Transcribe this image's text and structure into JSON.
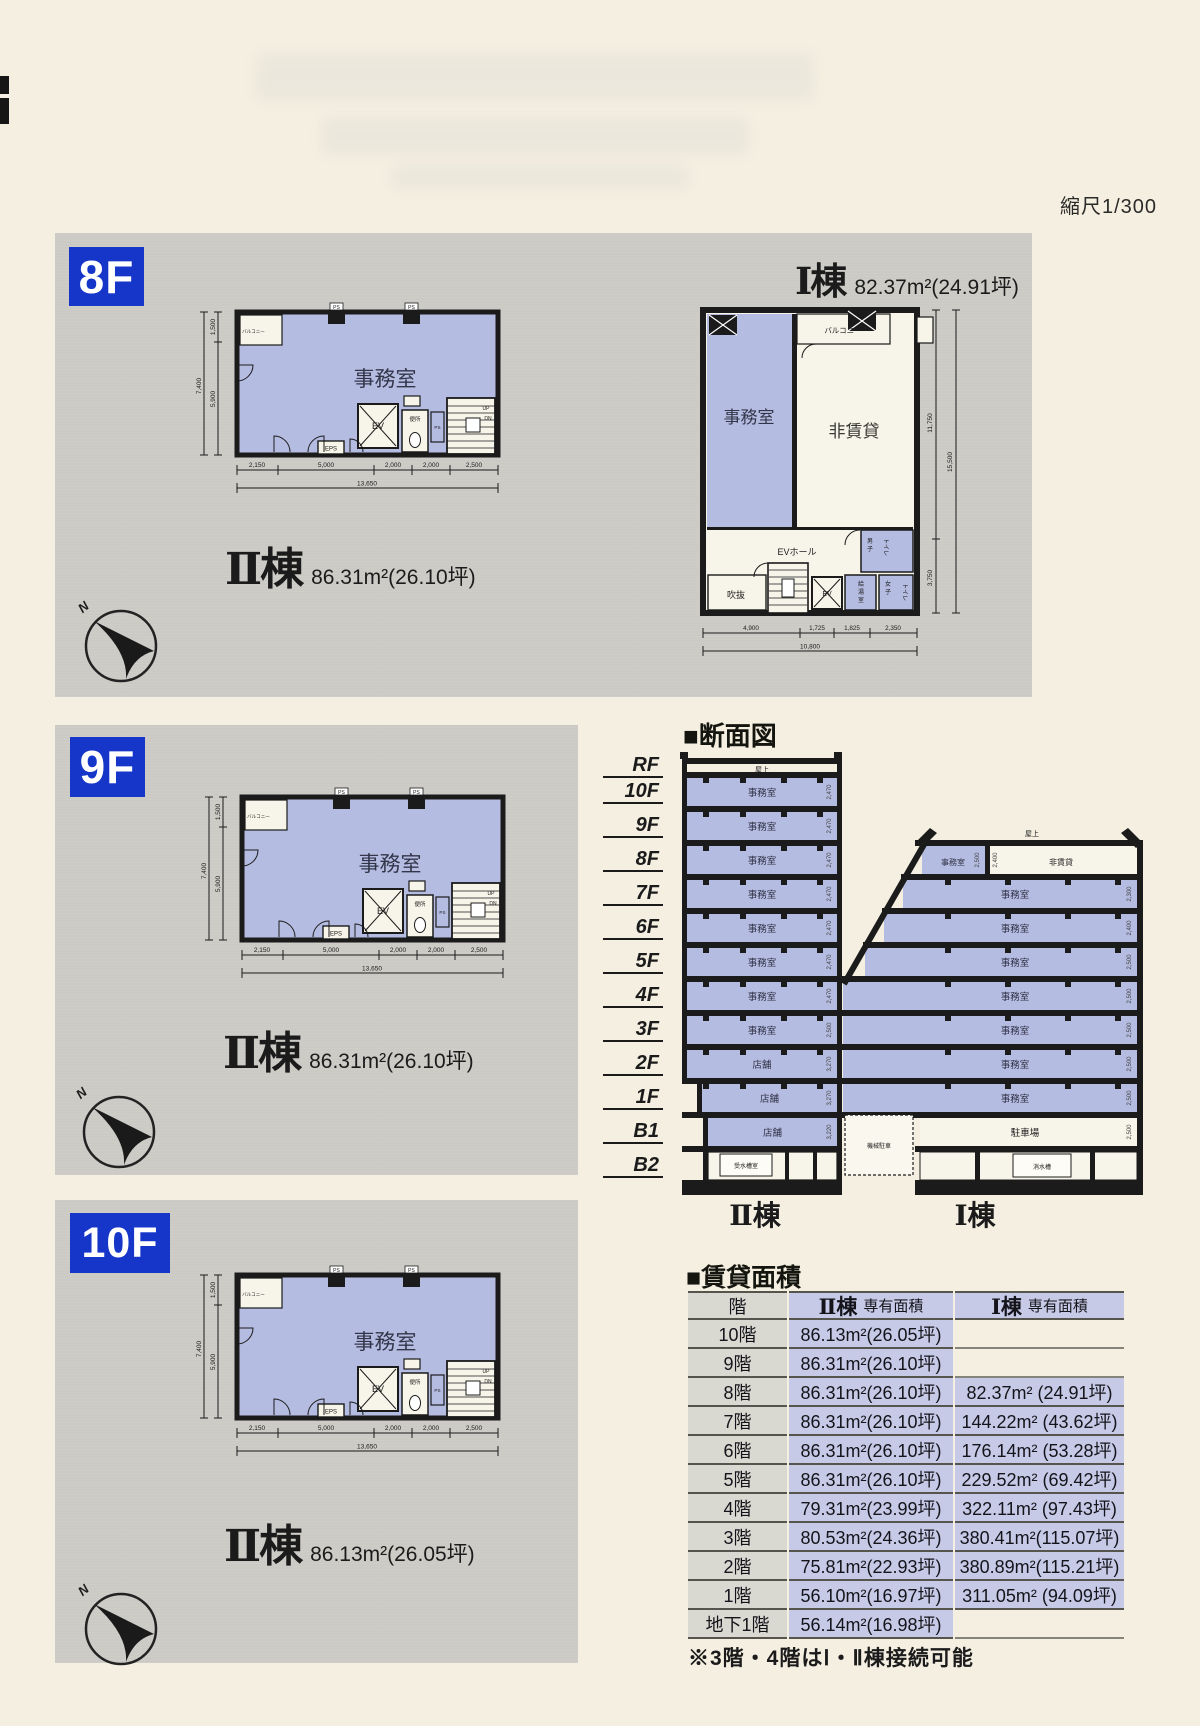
{
  "page": {
    "scale_note": "縮尺1/300"
  },
  "labels": {
    "office": "事務室",
    "store": "店舗",
    "balcony": "バルコニー",
    "non_rental": "非賃貸",
    "ev": "EV",
    "ev_hall": "EVホール",
    "eps": "EPS",
    "ps": "PS",
    "toilet": "便所",
    "up": "UP",
    "dn": "DN",
    "north": "N",
    "rooftop": "屋上",
    "mens": "男子",
    "womens": "女子",
    "toilet_kana": "トイレ",
    "void_space": "吹抜",
    "kitchenette": "給湯室",
    "water_tank_room": "受水槽室",
    "parking": "駐車場",
    "machine_parking": "機械駐車",
    "drainage_tank": "消水槽"
  },
  "floors": {
    "f8": {
      "tag": "8F",
      "b2_name": "Ⅱ棟",
      "b2_area": "86.31m²(26.10坪)",
      "b1_name": "Ⅰ棟",
      "b1_area": "82.37m²(24.91坪)"
    },
    "f9": {
      "tag": "9F",
      "b2_name": "Ⅱ棟",
      "b2_area": "86.31m²(26.10坪)"
    },
    "f10": {
      "tag": "10F",
      "b2_name": "Ⅱ棟",
      "b2_area": "86.13m²(26.05坪)"
    }
  },
  "plan2_dims": {
    "v_total": "7,400",
    "v_upper": "1,500",
    "v_lower": "5,900",
    "h": [
      "2,150",
      "5,000",
      "2,000",
      "2,000",
      "2,500"
    ],
    "h_total": "13,650"
  },
  "plan1_dims": {
    "v_upper": "11,750",
    "v_total": "15,500",
    "v_lower": "3,750",
    "h": [
      "4,900",
      "1,725",
      "1,825",
      "2,350"
    ],
    "h_total": "10,800"
  },
  "section": {
    "title": "■断面図",
    "floor_labels": [
      "RF",
      "10F",
      "9F",
      "8F",
      "7F",
      "6F",
      "5F",
      "4F",
      "3F",
      "2F",
      "1F",
      "B1",
      "B2"
    ],
    "b2_label": "Ⅱ棟",
    "b1_label": "Ⅰ棟",
    "b2_rows": [
      {
        "room": "事務室",
        "h": "2,470"
      },
      {
        "room": "事務室",
        "h": "2,470"
      },
      {
        "room": "事務室",
        "h": "2,470"
      },
      {
        "room": "事務室",
        "h": "2,470"
      },
      {
        "room": "事務室",
        "h": "2,470"
      },
      {
        "room": "事務室",
        "h": "2,470"
      },
      {
        "room": "事務室",
        "h": "2,470"
      },
      {
        "room": "事務室",
        "h": "2,500"
      },
      {
        "room": "店舗",
        "h": "3,270"
      },
      {
        "room": "店舗",
        "h": "3,270"
      },
      {
        "room": "店舗",
        "h": "3,220"
      },
      {
        "room": "受水槽室",
        "h": ""
      }
    ],
    "b1_rows": [
      {
        "rooms": [
          {
            "room": "事務室",
            "h": "2,500"
          },
          {
            "room": "非賃貸",
            "h": "2,400"
          }
        ]
      },
      {
        "room": "事務室",
        "h": "2,300"
      },
      {
        "room": "事務室",
        "h": "2,400"
      },
      {
        "room": "事務室",
        "h": "2,500"
      },
      {
        "room": "事務室",
        "h": "2,500"
      },
      {
        "room": "事務室",
        "h": "2,500"
      },
      {
        "room": "事務室",
        "h": "2,500"
      },
      {
        "room": "事務室",
        "h": "2,500"
      },
      {
        "room": "駐車場",
        "h": "2,500",
        "mid": "機械駐車"
      },
      {
        "room": "消水槽",
        "h": ""
      }
    ]
  },
  "table": {
    "title": "■賃貸面積",
    "col_floor": "階",
    "col_b2_name": "Ⅱ棟",
    "col_b2_sub": "専有面積",
    "col_b1_name": "Ⅰ棟",
    "col_b1_sub": "専有面積",
    "rows": [
      {
        "floor": "10階",
        "b2": "86.13m²(26.05坪)",
        "b1": ""
      },
      {
        "floor": "9階",
        "b2": "86.31m²(26.10坪)",
        "b1": ""
      },
      {
        "floor": "8階",
        "b2": "86.31m²(26.10坪)",
        "b1": "82.37m² (24.91坪)"
      },
      {
        "floor": "7階",
        "b2": "86.31m²(26.10坪)",
        "b1": "144.22m² (43.62坪)"
      },
      {
        "floor": "6階",
        "b2": "86.31m²(26.10坪)",
        "b1": "176.14m² (53.28坪)"
      },
      {
        "floor": "5階",
        "b2": "86.31m²(26.10坪)",
        "b1": "229.52m² (69.42坪)"
      },
      {
        "floor": "4階",
        "b2": "79.31m²(23.99坪)",
        "b1": "322.11m² (97.43坪)"
      },
      {
        "floor": "3階",
        "b2": "80.53m²(24.36坪)",
        "b1": "380.41m²(115.07坪)"
      },
      {
        "floor": "2階",
        "b2": "75.81m²(22.93坪)",
        "b1": "380.89m²(115.21坪)"
      },
      {
        "floor": "1階",
        "b2": "56.10m²(16.97坪)",
        "b1": "311.05m² (94.09坪)"
      },
      {
        "floor": "地下1階",
        "b2": "56.14m²(16.98坪)",
        "b1": ""
      }
    ],
    "note": "※3階・4階はⅠ・Ⅱ棟接続可能"
  }
}
